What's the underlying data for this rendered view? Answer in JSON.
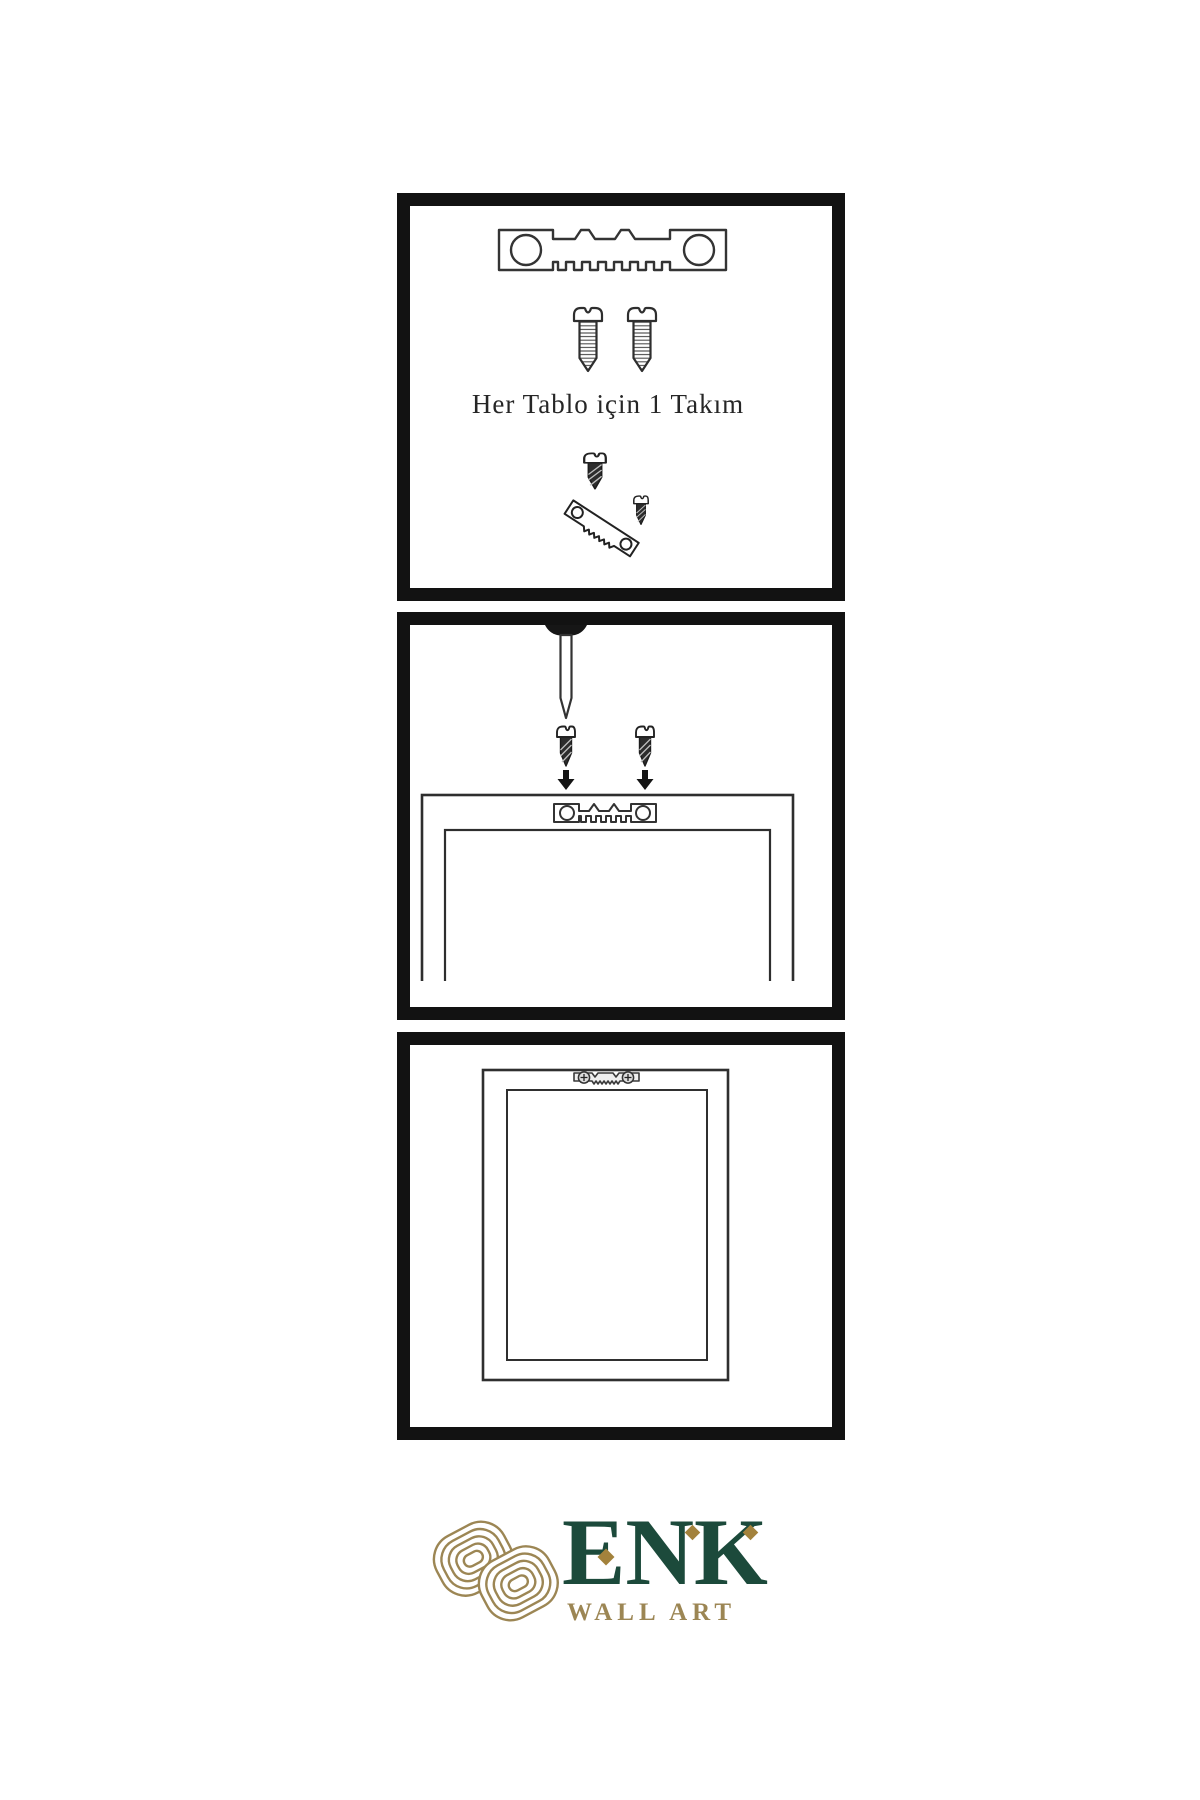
{
  "sheet": {
    "background": "#ffffff",
    "panel_border_color": "#121212",
    "line_art_color": "#2e2e2e"
  },
  "panels": {
    "kit": {
      "label": "Her Tablo için 1 Takım",
      "items": [
        "sawtooth-hanger",
        "screw",
        "screw",
        "screw",
        "tilted-sawtooth-hanger",
        "screw"
      ]
    },
    "mounting": {
      "items": [
        "nail-in-wall",
        "screw",
        "screw",
        "down-arrow",
        "down-arrow",
        "frame-back-with-sawtooth-hanger"
      ]
    },
    "hung": {
      "items": [
        "framed-artwork-hanging",
        "installed-sawtooth-hanger"
      ]
    }
  },
  "brand": {
    "wordmark": "ENK",
    "tagline": "WALL ART",
    "colors": {
      "wordmark_green": "#1c4a3b",
      "gold": "#9c8654",
      "diamond_gold": "#a3823c"
    }
  }
}
